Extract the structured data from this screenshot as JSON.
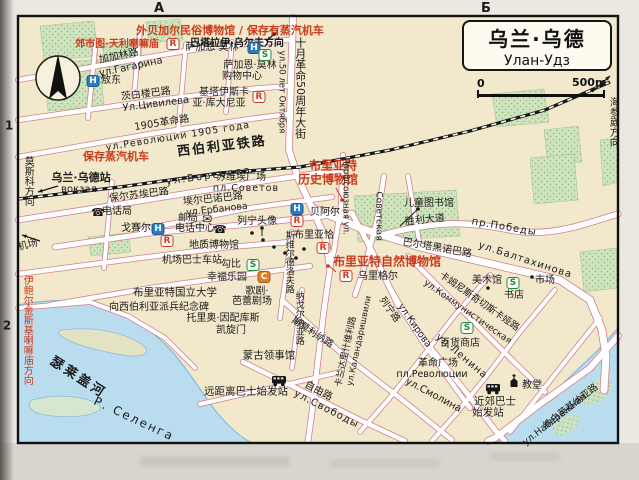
{
  "map": {
    "title_cn": "乌兰·乌德",
    "title_ru": "Улан-Удз",
    "scale_zero": "0",
    "scale_len": "500m",
    "colors": {
      "red": "#cc3a1c",
      "black": "#1c1c1c",
      "water": "#b9dcee",
      "park": "#cfe3bd",
      "road_casing": "#d4808f",
      "paper": "#f2e8cb"
    },
    "labels": [
      {
        "t": "外贝加尔民俗博物馆 / 保存有蒸汽机车",
        "x": 230,
        "y": 31,
        "s": 11,
        "c": "red",
        "b": true
      },
      {
        "t": "郊市图·天利喇嘛庙",
        "x": 117,
        "y": 45,
        "s": 10,
        "c": "red",
        "b": true
      },
      {
        "t": "巴塔拉伊·乌尔夫方向",
        "x": 237,
        "y": 44,
        "s": 10,
        "b": true
      },
      {
        "t": "加加林路",
        "x": 119,
        "y": 57,
        "r": -12,
        "s": 10
      },
      {
        "t": "ул.Гагарина",
        "x": 131,
        "y": 68,
        "r": -12,
        "s": 10
      },
      {
        "t": "敖东",
        "x": 111,
        "y": 81,
        "s": 10
      },
      {
        "t": "萨加恩·莫林",
        "x": 212,
        "y": 48,
        "s": 10
      },
      {
        "t": "萨加恩·莫林",
        "x": 250,
        "y": 66,
        "s": 10
      },
      {
        "t": "购物中心",
        "x": 242,
        "y": 77,
        "s": 10
      },
      {
        "t": "基塔伊斯卡",
        "x": 224,
        "y": 93,
        "s": 10
      },
      {
        "t": "亚·库大尼亚",
        "x": 219,
        "y": 104,
        "s": 10
      },
      {
        "t": "茨白楼巴路",
        "x": 146,
        "y": 95,
        "r": -7,
        "s": 10
      },
      {
        "t": "Ул.Цивилева",
        "x": 156,
        "y": 105,
        "r": -7,
        "s": 10
      },
      {
        "t": "1905革命路",
        "x": 162,
        "y": 124,
        "r": -9,
        "s": 10
      },
      {
        "t": "ул.Революции 1905 года",
        "x": 178,
        "y": 137,
        "r": -9,
        "s": 9.5,
        "ls": 1
      },
      {
        "t": "十月革命50周年大街",
        "x": 300,
        "y": 88,
        "v": true,
        "s": 11
      },
      {
        "t": "ул.50 лет Октября",
        "x": 281,
        "y": 92,
        "v": true,
        "s": 8.5
      },
      {
        "t": "西伯利亚铁路",
        "x": 222,
        "y": 147,
        "r": -7,
        "s": 13,
        "b": true,
        "ls": 2
      },
      {
        "t": "保存蒸汽机车",
        "x": 116,
        "y": 157,
        "s": 11,
        "c": "red",
        "b": true
      },
      {
        "t": "乌兰·乌德站",
        "x": 81,
        "y": 178,
        "s": 11,
        "b": true
      },
      {
        "t": "вокзал",
        "x": 79,
        "y": 190,
        "s": 10
      },
      {
        "t": "莫斯科方向",
        "x": 27,
        "y": 181,
        "v": true,
        "s": 10
      },
      {
        "t": "保尔苏埃巴路",
        "x": 139,
        "y": 196,
        "r": -7,
        "s": 10
      },
      {
        "t": "ул.Борсоева",
        "x": 209,
        "y": 177,
        "r": -8,
        "s": 10,
        "ls": 2
      },
      {
        "t": "电话局",
        "x": 117,
        "y": 212,
        "s": 10
      },
      {
        "t": "邮局",
        "x": 188,
        "y": 219,
        "s": 10
      },
      {
        "t": "苏维埃广场",
        "x": 241,
        "y": 178,
        "s": 10
      },
      {
        "t": "пл.Советов",
        "x": 246,
        "y": 189,
        "s": 9.5,
        "ls": 1
      },
      {
        "t": "埃尔巴诺巴路",
        "x": 213,
        "y": 200,
        "r": -6,
        "s": 10
      },
      {
        "t": "ул.Ербанова",
        "x": 217,
        "y": 210,
        "r": -6,
        "s": 9.5
      },
      {
        "t": "布里亚特",
        "x": 333,
        "y": 166,
        "s": 12,
        "c": "red",
        "b": true
      },
      {
        "t": "历史博物馆",
        "x": 328,
        "y": 180,
        "s": 12,
        "c": "red",
        "b": true
      },
      {
        "t": "电话中心",
        "x": 195,
        "y": 229,
        "s": 10
      },
      {
        "t": "戈赛尔",
        "x": 136,
        "y": 229,
        "s": 10
      },
      {
        "t": "列宁头像",
        "x": 257,
        "y": 222,
        "s": 10
      },
      {
        "t": "贝阿尔",
        "x": 325,
        "y": 213,
        "s": 10
      },
      {
        "t": "布里亚恰",
        "x": 314,
        "y": 236,
        "s": 10
      },
      {
        "t": "Профсоюзная ул.",
        "x": 345,
        "y": 196,
        "v": true,
        "s": 8.5
      },
      {
        "t": "Советская",
        "x": 378,
        "y": 216,
        "v": true,
        "s": 9
      },
      {
        "t": "儿童图书馆",
        "x": 429,
        "y": 204,
        "s": 10
      },
      {
        "t": "胜利大道",
        "x": 425,
        "y": 221,
        "r": -6,
        "s": 10
      },
      {
        "t": "пр.Победы",
        "x": 504,
        "y": 228,
        "r": 10,
        "s": 10,
        "ls": 1
      },
      {
        "t": "巴尔塔黑诺巴路",
        "x": 437,
        "y": 249,
        "r": 10,
        "s": 10
      },
      {
        "t": "ул.Балтахинова",
        "x": 525,
        "y": 261,
        "r": 18,
        "s": 10,
        "ls": 1
      },
      {
        "t": "布里亚特自然博物馆",
        "x": 387,
        "y": 262,
        "s": 12,
        "c": "red",
        "b": true
      },
      {
        "t": "乌里格尔",
        "x": 378,
        "y": 277,
        "s": 10
      },
      {
        "t": "美术馆",
        "x": 487,
        "y": 281,
        "s": 10
      },
      {
        "t": "市场",
        "x": 545,
        "y": 281,
        "s": 10
      },
      {
        "t": "书店",
        "x": 514,
        "y": 296,
        "s": 10
      },
      {
        "t": "卡姆尼斯奇切斯卡娅路",
        "x": 479,
        "y": 302,
        "r": 35,
        "s": 9.5
      },
      {
        "t": "ул.Коммунистическая",
        "x": 467,
        "y": 313,
        "r": 35,
        "s": 9
      },
      {
        "t": "百货商店",
        "x": 460,
        "y": 344,
        "s": 10
      },
      {
        "t": "革命广场",
        "x": 438,
        "y": 364,
        "s": 10
      },
      {
        "t": "пл.Революции",
        "x": 432,
        "y": 375,
        "s": 9.5
      },
      {
        "t": "列宁路",
        "x": 389,
        "y": 310,
        "r": 55,
        "s": 9.5
      },
      {
        "t": "ул.Ленина",
        "x": 461,
        "y": 357,
        "r": 40,
        "s": 10,
        "ls": 1
      },
      {
        "t": "ул.Кирова",
        "x": 414,
        "y": 326,
        "r": 55,
        "s": 9.5
      },
      {
        "t": "斯莫利纳路",
        "x": 312,
        "y": 333,
        "r": 33,
        "s": 9.5
      },
      {
        "t": "ул.Смолина",
        "x": 433,
        "y": 396,
        "r": 28,
        "s": 10
      },
      {
        "t": "卡兰达里什维利路",
        "x": 347,
        "y": 352,
        "r": -78,
        "s": 9
      },
      {
        "t": "ул.Каландаришвили",
        "x": 360,
        "y": 341,
        "r": -78,
        "s": 8.5
      },
      {
        "t": "纳戈尔纳亚路",
        "x": 298,
        "y": 318,
        "v": true,
        "s": 9
      },
      {
        "t": "斯维尔德洛夫路",
        "x": 288,
        "y": 262,
        "v": true,
        "s": 9
      },
      {
        "t": "托里奥·因配库斯",
        "x": 223,
        "y": 319,
        "s": 10
      },
      {
        "t": "凯旋门",
        "x": 231,
        "y": 331,
        "s": 10
      },
      {
        "t": "蒙古领事馆",
        "x": 269,
        "y": 356,
        "s": 10.5
      },
      {
        "t": "布里亚特国立大学",
        "x": 175,
        "y": 293,
        "s": 10.5
      },
      {
        "t": "向西伯利亚派兵纪念碑",
        "x": 159,
        "y": 308,
        "s": 10
      },
      {
        "t": "歌剧·",
        "x": 257,
        "y": 292,
        "s": 10
      },
      {
        "t": "芭蕾剧场",
        "x": 252,
        "y": 302,
        "s": 10
      },
      {
        "t": "幸福乐园",
        "x": 227,
        "y": 278,
        "s": 10
      },
      {
        "t": "勾比",
        "x": 231,
        "y": 265,
        "s": 10
      },
      {
        "t": "地质博物馆",
        "x": 214,
        "y": 246,
        "s": 10
      },
      {
        "t": "机场巴士车站",
        "x": 192,
        "y": 261,
        "s": 10
      },
      {
        "t": "机场",
        "x": 28,
        "y": 246,
        "r": -15,
        "s": 10
      },
      {
        "t": "伊鲍尔金斯基喇嘛庙方向",
        "x": 26,
        "y": 330,
        "v": true,
        "s": 10,
        "c": "red"
      },
      {
        "t": "瑟莱盖河",
        "x": 78,
        "y": 378,
        "r": 33,
        "s": 13,
        "b": true,
        "ls": 3
      },
      {
        "t": "Р. Селенга",
        "x": 134,
        "y": 419,
        "r": 25,
        "s": 12,
        "ls": 2
      },
      {
        "t": "远距离巴士始发站",
        "x": 246,
        "y": 392,
        "s": 10.5
      },
      {
        "t": "自由路",
        "x": 318,
        "y": 392,
        "r": 27,
        "s": 10
      },
      {
        "t": "ул.Свободы",
        "x": 326,
        "y": 410,
        "r": 27,
        "s": 10,
        "ls": 1
      },
      {
        "t": "近郊巴士",
        "x": 495,
        "y": 402,
        "s": 10.5
      },
      {
        "t": "始发站",
        "x": 488,
        "y": 413,
        "s": 10.5
      },
      {
        "t": "教堂",
        "x": 532,
        "y": 386,
        "s": 10
      },
      {
        "t": "纳白莱基纳亚路",
        "x": 571,
        "y": 407,
        "r": -38,
        "s": 9.5
      },
      {
        "t": "ул.Набережная",
        "x": 555,
        "y": 420,
        "r": -38,
        "s": 9.5
      },
      {
        "t": "海参崴方向",
        "x": 612,
        "y": 122,
        "v": true,
        "s": 10
      },
      {
        "t": "А",
        "x": 159,
        "y": 9,
        "s": 13,
        "b": true
      },
      {
        "t": "Б",
        "x": 486,
        "y": 9,
        "s": 13,
        "b": true
      },
      {
        "t": "1",
        "x": 9,
        "y": 126,
        "s": 12,
        "b": true
      },
      {
        "t": "2",
        "x": 7,
        "y": 326,
        "s": 12,
        "b": true
      }
    ],
    "markers": [
      {
        "k": "R",
        "x": 173,
        "y": 44
      },
      {
        "k": "H",
        "x": 93,
        "y": 81
      },
      {
        "k": "H",
        "x": 254,
        "y": 48
      },
      {
        "k": "S",
        "x": 265,
        "y": 55
      },
      {
        "k": "R",
        "x": 259,
        "y": 97
      },
      {
        "k": "H",
        "x": 297,
        "y": 209
      },
      {
        "k": "R",
        "x": 297,
        "y": 221
      },
      {
        "k": "H",
        "x": 158,
        "y": 229
      },
      {
        "k": "R",
        "x": 167,
        "y": 241
      },
      {
        "k": "S",
        "x": 253,
        "y": 265
      },
      {
        "k": "C",
        "x": 264,
        "y": 277
      },
      {
        "k": "R",
        "x": 323,
        "y": 248
      },
      {
        "k": "R",
        "x": 346,
        "y": 276
      },
      {
        "k": "S",
        "x": 513,
        "y": 283
      },
      {
        "k": "S",
        "x": 467,
        "y": 328
      }
    ],
    "marker_names": {
      "H": "hotel-marker",
      "R": "restaurant-marker",
      "S": "shop-marker",
      "C": "culture-marker"
    },
    "icons": [
      {
        "k": "bus",
        "x": 279,
        "y": 380
      },
      {
        "k": "bus",
        "x": 493,
        "y": 388
      },
      {
        "k": "church",
        "x": 514,
        "y": 383
      },
      {
        "k": "mail",
        "x": 207,
        "y": 219
      },
      {
        "k": "phone",
        "x": 98,
        "y": 212
      },
      {
        "k": "phone",
        "x": 220,
        "y": 229
      },
      {
        "k": "compass",
        "x": 58,
        "y": 78
      }
    ],
    "dots": [
      {
        "x": 342,
        "y": 200,
        "c": "red"
      },
      {
        "x": 328,
        "y": 266,
        "c": "red"
      },
      {
        "x": 488,
        "y": 288
      },
      {
        "x": 532,
        "y": 277
      },
      {
        "x": 418,
        "y": 209
      },
      {
        "x": 262,
        "y": 228
      },
      {
        "x": 252,
        "y": 233
      },
      {
        "x": 263,
        "y": 240
      },
      {
        "x": 274,
        "y": 247
      },
      {
        "x": 285,
        "y": 253
      },
      {
        "x": 296,
        "y": 258
      },
      {
        "x": 304,
        "y": 249
      }
    ],
    "lines": [
      {
        "x1": 342,
        "y1": 199,
        "x2": 336,
        "y2": 188,
        "c": "red"
      },
      {
        "x1": 418,
        "y1": 209,
        "x2": 400,
        "y2": 226
      },
      {
        "x1": 262,
        "y1": 228,
        "x2": 262,
        "y2": 236
      },
      {
        "x1": 328,
        "y1": 265,
        "x2": 336,
        "y2": 272,
        "c": "red"
      }
    ],
    "arrows": [
      {
        "x1": 592,
        "y1": 92,
        "x2": 610,
        "y2": 76
      },
      {
        "x1": 58,
        "y1": 186,
        "x2": 38,
        "y2": 192
      },
      {
        "x1": 40,
        "y1": 241,
        "x2": 22,
        "y2": 235
      },
      {
        "x1": 266,
        "y1": 41,
        "x2": 277,
        "y2": 32
      }
    ]
  }
}
